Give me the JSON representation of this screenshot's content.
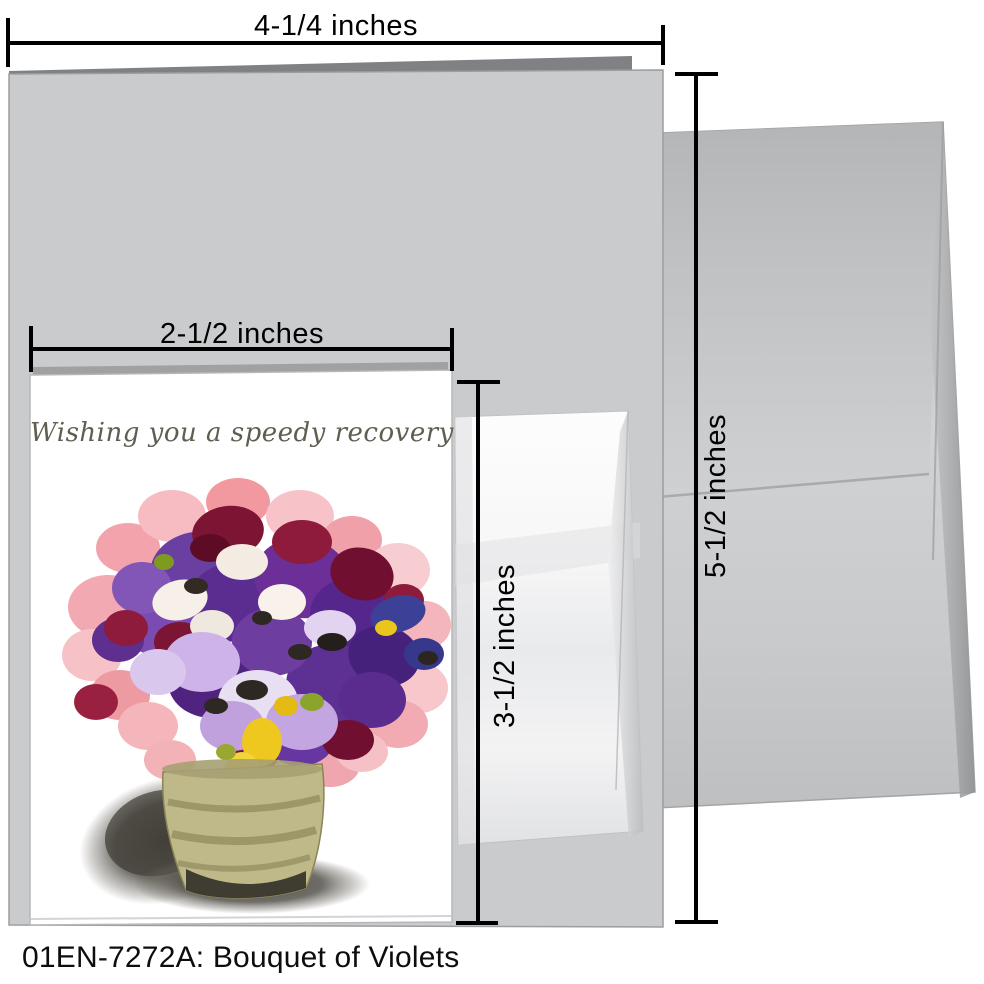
{
  "product": {
    "caption": "01EN-7272A: Bouquet of Violets"
  },
  "card": {
    "message": "Wishing you a speedy recovery",
    "message_color": "#605e50",
    "artwork": "painted bouquet of violets and pansies in a ribbed olive pot with cast shadow"
  },
  "dimensions": {
    "outer_card_width": "4-1/4 inches",
    "envelope_height": "5-1/2 inches",
    "inner_card_width": "2-1/2 inches",
    "inner_card_height": "3-1/2 inches"
  },
  "palette": {
    "outer_card_gray": "#c9cbcd",
    "card_fold_gray": "#7f8184",
    "envelope_gray": "#c6c7c9",
    "small_envelope_white": "#f6f6f7",
    "dimension_line_black": "#000000",
    "flower_purple": "#5b2d90",
    "flower_pink": "#f3a9b1",
    "flower_maroon": "#7c1434",
    "flower_yellow": "#eec81f",
    "pot_olive": "#bfb98a",
    "shadow_gray": "#44413a"
  }
}
